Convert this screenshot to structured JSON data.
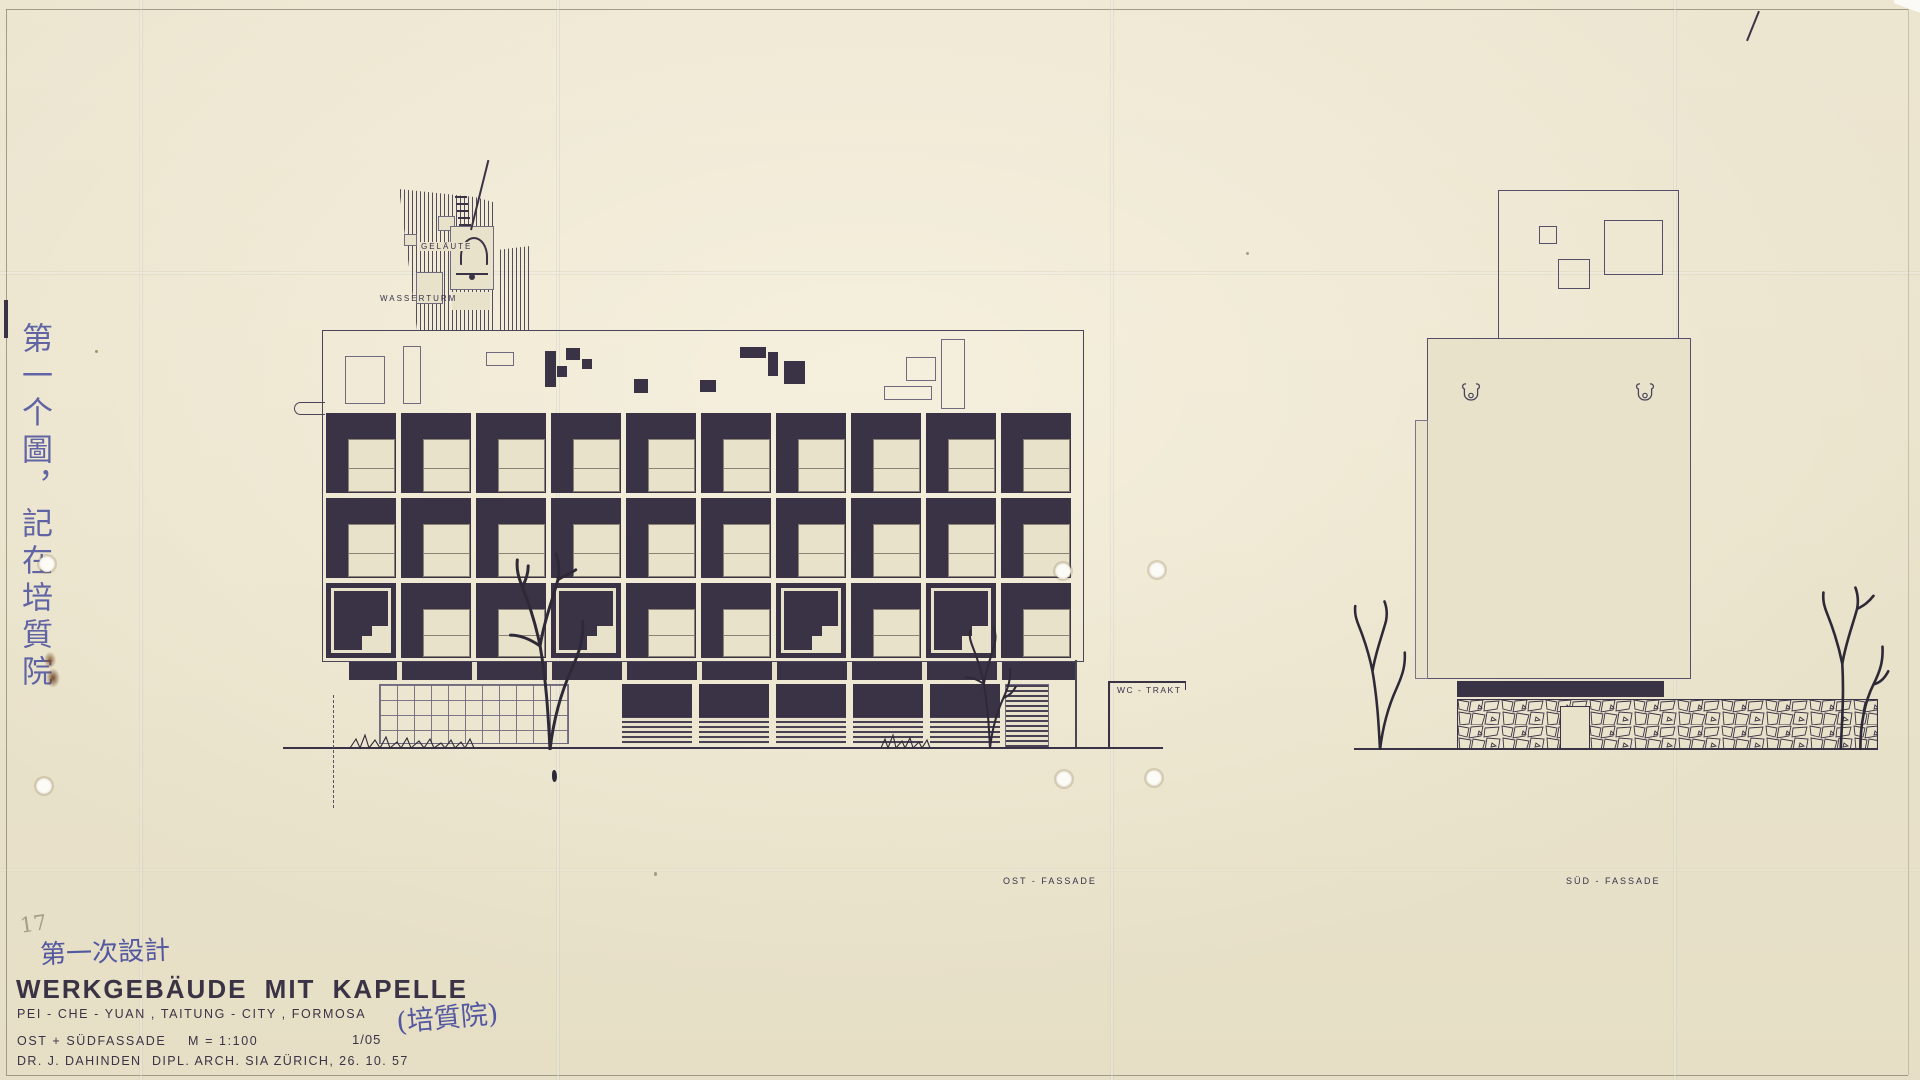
{
  "labels": {
    "gelaeute": "GELÄUTE",
    "wasserturm": "WASSERTURM",
    "wc_trakt": "WC - TRAKT",
    "ost_fassade": "OST - FASSADE",
    "sued_fassade": "SÜD - FASSADE"
  },
  "annotations": {
    "pencil_number": "17",
    "side_note_vertical": "第一个圖，記在培質院",
    "design_note": "第一次設計",
    "name_note": "(培質院)"
  },
  "title_block": {
    "title": "WERKGEBÄUDE MIT KAPELLE",
    "subtitle": "PEI - CHE - YUAN , TAITUNG - CITY , FORMOSA",
    "views": "OST + SÜDFASSADE",
    "scale": "M = 1:100",
    "sheet_no": "1/05",
    "architect": "DR. J. DAHINDEN",
    "credentials": "DIPL. ARCH. SIA ZÜRICH, 26. 10. 57"
  },
  "colors": {
    "paper": "#e9e2cb",
    "ink": "#3a3345",
    "thin_line": "#6f6a7e",
    "handwriting_ink": "#5257a0",
    "pencil": "#a39b89",
    "stain": "#8a5526"
  },
  "drawing": {
    "east_facade": {
      "rows": 3,
      "cols": 10,
      "row_tops": [
        413,
        498,
        583
      ],
      "row_heights": [
        80,
        80,
        75
      ],
      "col_start": 326,
      "col_pitch": 75,
      "module_width": 70,
      "variant_cols_row3": [
        0,
        3,
        6,
        8
      ],
      "attic_outlined_rects": [
        [
          345,
          356,
          38,
          46
        ],
        [
          403,
          346,
          16,
          56
        ],
        [
          486,
          352,
          26,
          12
        ],
        [
          884,
          386,
          46,
          12
        ],
        [
          906,
          357,
          28,
          22
        ],
        [
          941,
          339,
          22,
          68
        ]
      ],
      "attic_filled_rects": [
        [
          545,
          351,
          11,
          36
        ],
        [
          566,
          348,
          14,
          12
        ],
        [
          557,
          366,
          10,
          11
        ],
        [
          582,
          359,
          10,
          10
        ],
        [
          634,
          379,
          14,
          14
        ],
        [
          700,
          380,
          16,
          12
        ],
        [
          740,
          347,
          26,
          11
        ],
        [
          768,
          352,
          10,
          24
        ],
        [
          784,
          361,
          21,
          23
        ]
      ],
      "spandrel_mullions": [
        48,
        123,
        198,
        273,
        348,
        423,
        498,
        573,
        648
      ],
      "storefront_bay_xs": [
        622,
        699,
        776,
        853,
        930
      ],
      "tower_small_openings": [
        [
          404,
          234,
          11,
          10
        ],
        [
          438,
          216,
          15,
          13
        ],
        [
          416,
          272,
          25,
          30
        ],
        [
          452,
          292,
          38,
          18
        ]
      ]
    },
    "south_facade": {
      "tower_squares": [
        [
          1539,
          226,
          16,
          16
        ],
        [
          1558,
          259,
          30,
          28
        ],
        [
          1604,
          220,
          57,
          53
        ]
      ],
      "bell_opening_xs": [
        1460,
        1634
      ]
    }
  }
}
